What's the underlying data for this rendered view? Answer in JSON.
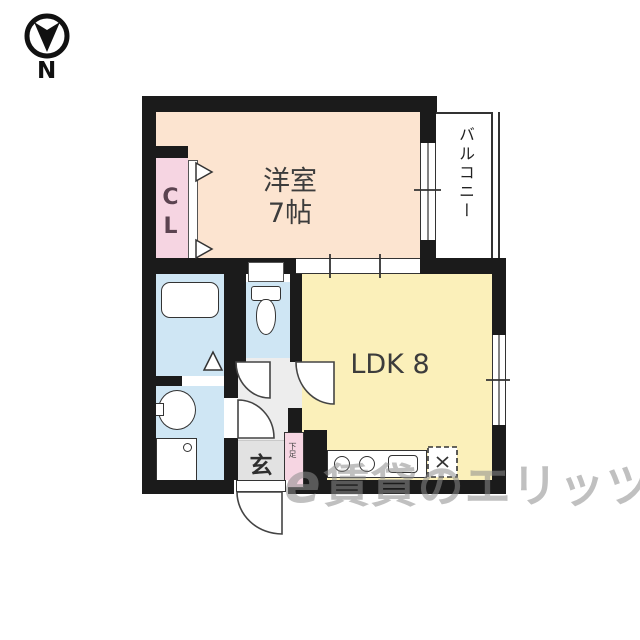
{
  "compass": {
    "label": "N"
  },
  "floor_plan": {
    "western_room": {
      "name": "洋室",
      "size": "7帖"
    },
    "ldk": {
      "label": "LDK 8"
    },
    "closet": {
      "label": "CL"
    },
    "balcony": {
      "label": "バルコニー"
    },
    "entrance": {
      "label": "玄"
    },
    "shoe_cabinet": {
      "label": "下足"
    },
    "fixtures": [
      "bathtub",
      "toilet",
      "washbasin",
      "washing-machine-pan",
      "kitchen-counter",
      "burners",
      "kitchen-sink",
      "gas-stove"
    ]
  },
  "watermark": {
    "logo_mark": "e",
    "text": "賃貸のエリッツ"
  },
  "colors": {
    "wall": "#1b1b1b",
    "western_room": "#fce4d0",
    "ldk": "#fbf0ba",
    "closet_pink": "#f6d5e2",
    "wet_area_blue": "#cfe6f4",
    "hall_gray": "#ededed",
    "entrance_gray": "#e2e2e2",
    "watermark_gray": "#8c8c8c"
  }
}
